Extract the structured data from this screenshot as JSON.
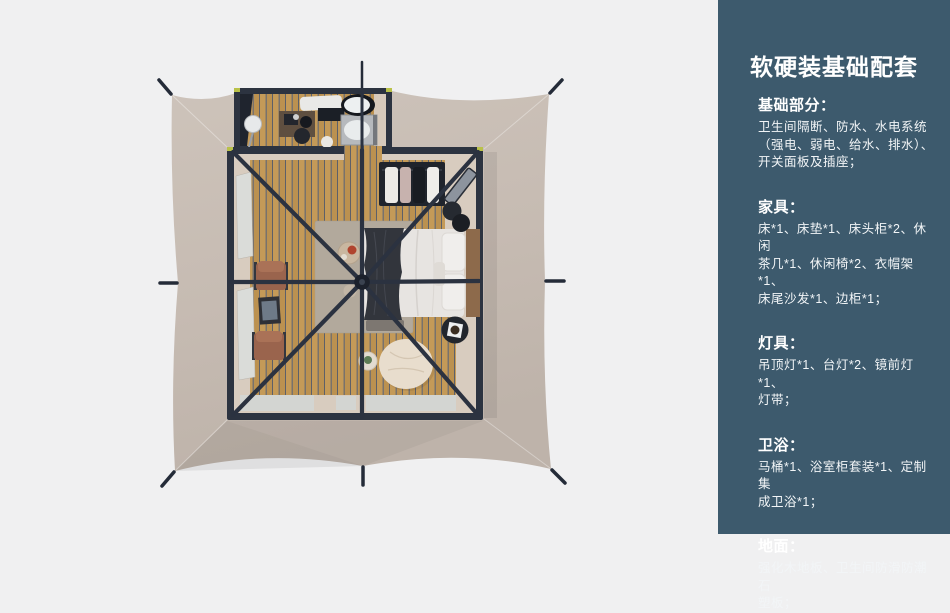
{
  "page": {
    "background": "#f0f0f1"
  },
  "floorplan": {
    "canopy_color": "#c6bbb2",
    "frame_color": "#2b3240",
    "wood_floor_color": "#c49a58",
    "icons": [
      "tent-canopy",
      "bathroom-annex",
      "toilet",
      "shower-unit",
      "vanity-desk",
      "bed",
      "pillows",
      "throw-blanket",
      "area-rug",
      "clothes-rack",
      "mirror",
      "armchair",
      "bean-bag",
      "side-table",
      "roof-frame"
    ]
  },
  "panel": {
    "background": "#3d5a6d",
    "title": "软硬装基础配套",
    "sections": [
      {
        "heading": "基础部分：",
        "body": "卫生间隔断、防水、水电系统\n（强电、弱电、给水、排水）、\n开关面板及插座；"
      },
      {
        "heading": "家具：",
        "body": "床*1、床垫*1、床头柜*2、休闲\n茶几*1、休闲椅*2、衣帽架*1、\n床尾沙发*1、边柜*1；"
      },
      {
        "heading": "灯具：",
        "body": "吊顶灯*1、台灯*2、镜前灯*1、\n灯带；"
      },
      {
        "heading": "卫浴：",
        "body": "马桶*1、浴室柜套装*1、定制集\n成卫浴*1；"
      },
      {
        "heading": "地面：",
        "body": "强化木地板、卫生间防滑防潮石\n塑板；"
      }
    ]
  }
}
